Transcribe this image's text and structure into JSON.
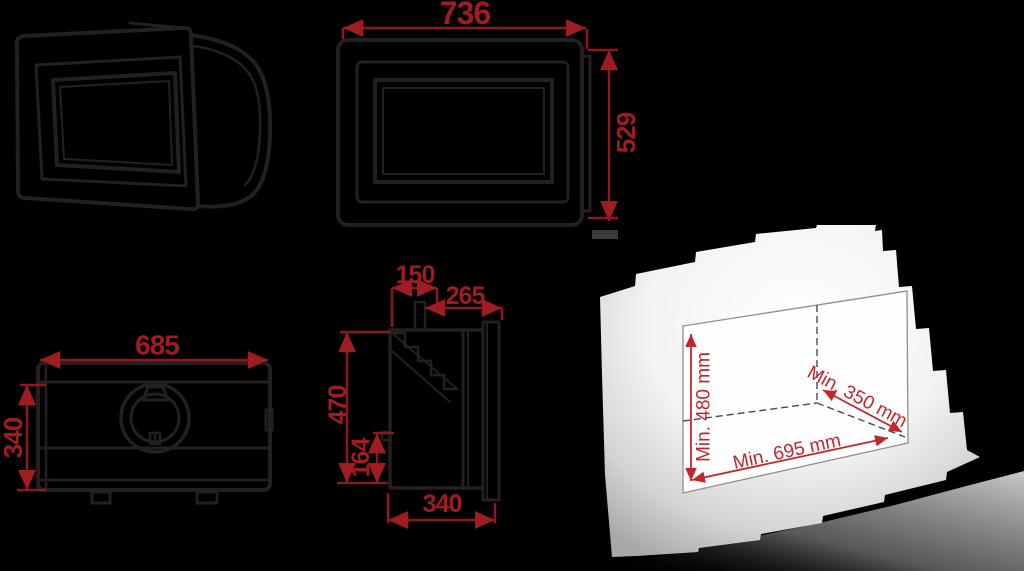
{
  "colors": {
    "background": "#000000",
    "line_art": "#241f21",
    "dimension_text_red": "#9f1d20",
    "dimension_line_red": "#8e191c",
    "niche_red": "#c2262b",
    "wall_white": "#ffffff",
    "wall_gray": "#a8a8a8"
  },
  "views": {
    "front_view": {
      "width": "736",
      "height": "529"
    },
    "rear_view": {
      "width": "685",
      "height": "340"
    },
    "side_view": {
      "top_inset": "150",
      "top_depth": "265",
      "height": "470",
      "lower_height": "164",
      "bottom_depth": "340"
    },
    "niche_cutout": {
      "min_height": "Min. 480 mm",
      "min_depth": "Min. 350 mm",
      "min_width": "Min. 695 mm"
    }
  }
}
